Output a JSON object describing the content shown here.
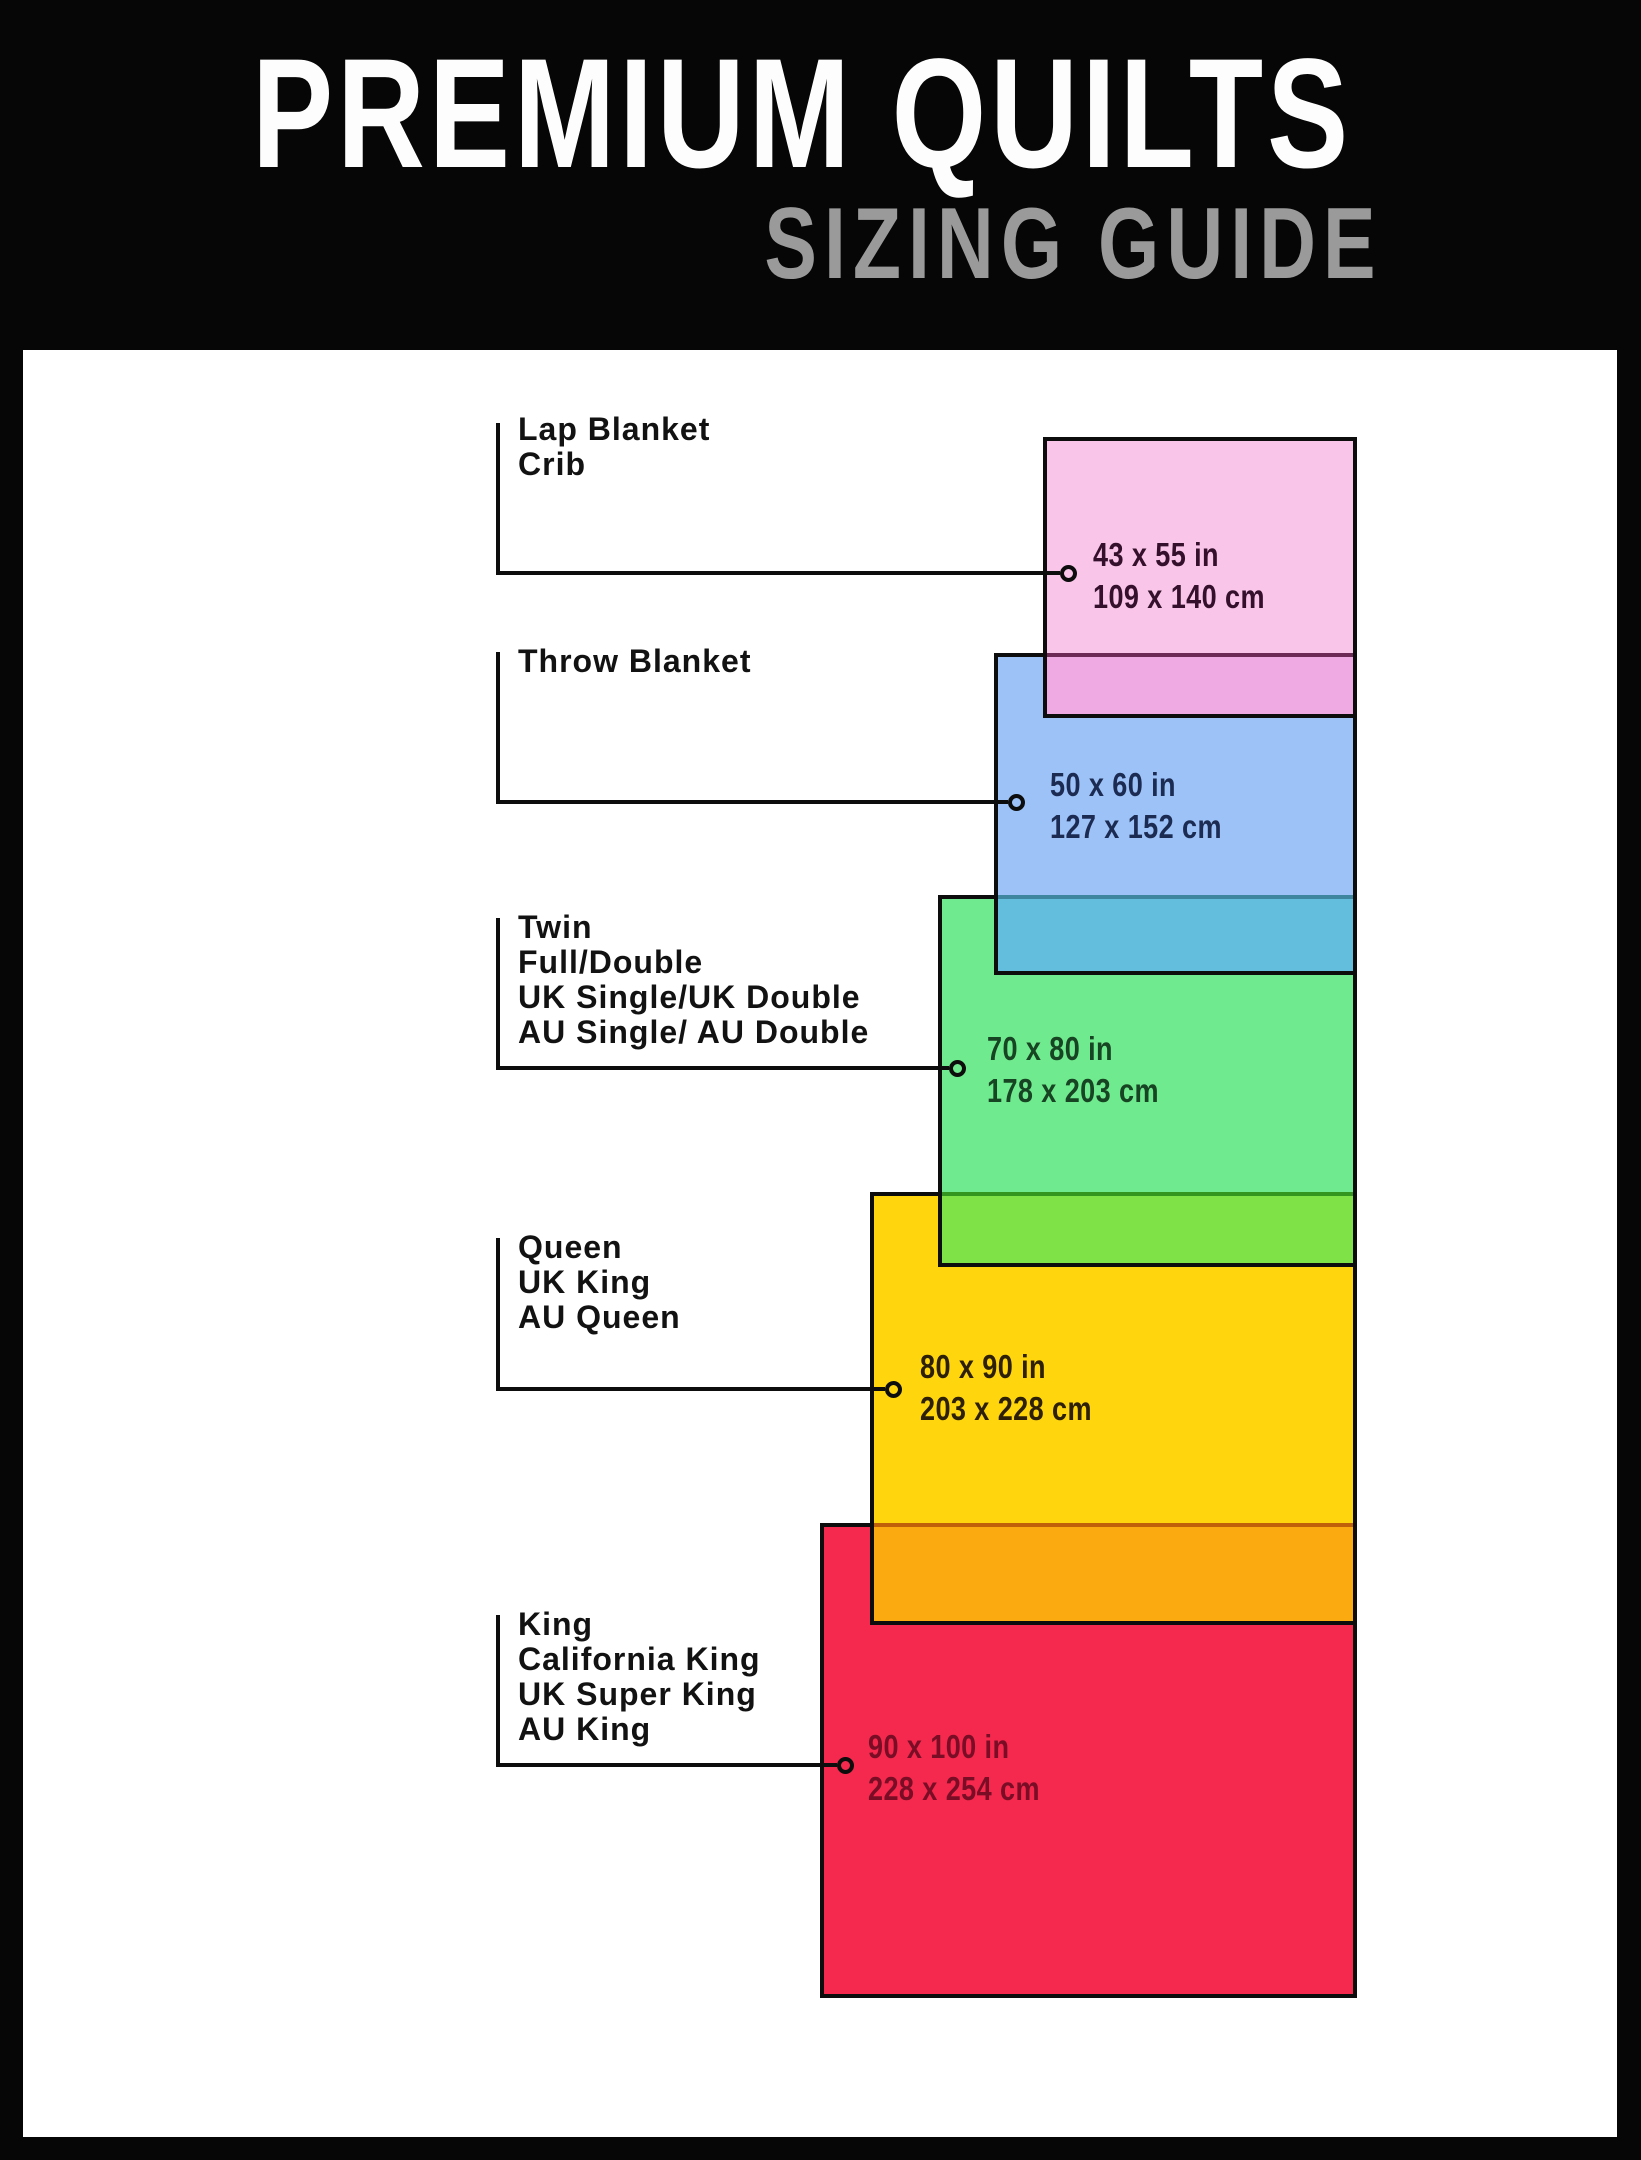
{
  "header": {
    "title": "PREMIUM QUILTS",
    "subtitle": "SIZING GUIDE"
  },
  "frame_color": "#060606",
  "canvas_color": "#ffffff",
  "sizes": [
    {
      "name": "lap-blanket-crib",
      "labels": [
        "Lap Blanket",
        "Crib"
      ],
      "inches": "43 x 55 in",
      "cm": "109 x 140 cm",
      "fill": "#f9c6e9",
      "overlap_with_next": "#efaae4",
      "text_color": "#35102c"
    },
    {
      "name": "throw-blanket",
      "labels": [
        "Throw Blanket"
      ],
      "inches": "50 x 60 in",
      "cm": "127 x 152 cm",
      "fill": "#9cc2f7",
      "overlap_with_next": "#63bedd",
      "text_color": "#1c2b52"
    },
    {
      "name": "twin-full-double",
      "labels": [
        "Twin",
        "Full/Double",
        "UK Single/UK Double",
        "AU Single/ AU Double"
      ],
      "inches": "70 x 80 in",
      "cm": "178 x 203 cm",
      "fill": "#70ea8e",
      "overlap_with_next": "#7fe348",
      "text_color": "#174423"
    },
    {
      "name": "queen-uk-king-au-queen",
      "labels": [
        "Queen",
        "UK King",
        "AU Queen"
      ],
      "inches": "80 x 90 in",
      "cm": "203 x 228 cm",
      "fill": "#ffd60e",
      "overlap_with_next": "#fbaa0f",
      "text_color": "#2d2005"
    },
    {
      "name": "king-california-king",
      "labels": [
        "King",
        "California King",
        "UK Super King",
        "AU King"
      ],
      "inches": "90 x 100 in",
      "cm": "228 x 254 cm",
      "fill": "#f5294e",
      "text_color": "#7a0d26"
    }
  ]
}
